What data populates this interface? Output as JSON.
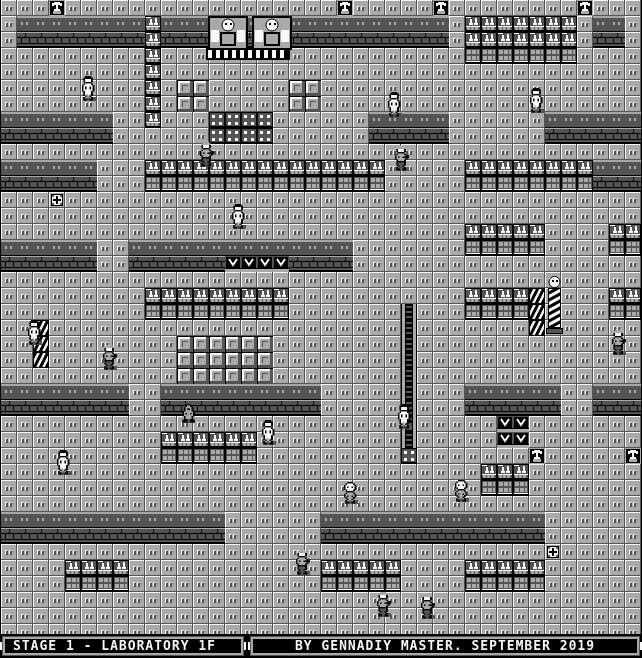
{
  "status_bar": {
    "stage_text": "STAGE 1 - LABORATORY 1F",
    "credits_text": "BY GENNADIY MASTER. SEPTEMBER 2019"
  },
  "palette": {
    "k": "#000000",
    "d": "#545454",
    "l": "#a9a9a9",
    "w": "#f8f8f8"
  },
  "map": {
    "tile_size": 16,
    "cols": 40,
    "rows": 40,
    "legend": {
      ".": "floor-tile",
      "=": "wall-top",
      "#": "wall-face",
      "S": "shelf-flasks",
      "s": "shelf-boxes",
      "C": "crate",
      "V": "press-machine",
      "/": "hazard-pillar",
      "A": "alcove-statue",
      "+": "first-aid-box",
      "o": "lab-table-dots",
      "|": "conveyor"
    },
    "rows_data": [
      "...A.................A.....A........A...",
      ".========S==================.SSSSSSS.==.",
      ".########S##################.SSSSSSS.##.",
      ".........S...................sssssss....",
      ".........S..............................",
      ".........S.CC.....CC....................",
      ".........S.CC.....CC....................",
      "=======..S...oooo......=====......======",
      "#######......oooo......#####......######",
      "........................................",
      "======...SSSSSSSSSSSSSSS.....SSSSSSSS===",
      "######...sssssssssssssss.....ssssssss###",
      "...+....................................",
      "........................................",
      ".............................SSSSS....SS",
      "======..==============.......sssss....ss",
      "######..######VVVV####..................",
      "........................................",
      ".........SSSSSSSSS...........SSSS/....SS",
      ".........sssssssss.......|...ssss/....ss",
      "../......................|......./......",
      "../........CCCCCC........|..............",
      "../........CCCCCC........|..............",
      "...........CCCCCC........|..............",
      "========..==========.....|...======..===",
      "########..##########.....|...######..###",
      ".........................|.....VV.......",
      "..........SSSSSS.........|.....VV.......",
      "..........ssssss.........o.......A.....A",
      "..............................SSS.......",
      "..............................sss.......",
      "........................................",
      "==============......==============......",
      "##############......##############......",
      "..................................+.....",
      "....SSSS............SSSSS....SSSSS......",
      "....ssss............sssss....sssss......",
      "........................................",
      "........................................",
      "........................................"
    ]
  },
  "machine": {
    "name": "twin-robot-machine",
    "x": 206,
    "y": 16
  },
  "mannequin": {
    "name": "striped-mannequin",
    "x": 546,
    "y": 276
  },
  "sprites": {
    "defs": {
      "scientist": [
        "..kkkk....",
        ".kkkkkk...",
        ".kwwwwk...",
        ".kwwwwk...",
        "..kkkk....",
        ".kwwwwk...",
        "kwwwwwwk..",
        "kwkwwkwk..",
        "kwkwwkwk..",
        "kwwwwwwk..",
        ".kwwwwk...",
        ".kwwwwk...",
        ".kwlwlk...",
        "..kllk....",
        ".kl..lk...",
        ".kk..kk..."
      ],
      "soldier": [
        "..llll....",
        ".llllll...",
        ".kwwwwk...",
        ".kwwwwk...",
        "..kkkk....",
        ".kllllk...",
        "kllllllkk.",
        "klkllkkkk.",
        "kllllllk..",
        ".kllllk...",
        ".kkkkkk...",
        ".kddddk...",
        ".kddddk...",
        "..kddk....",
        ".kd..dk...",
        ".kk..kk..."
      ],
      "robot": [
        "..kkkk....",
        ".kwwwwk...",
        "kwwwwwwk..",
        "kwkwwkwk..",
        "kwwwwwwk..",
        ".kwwwwk...",
        "..kkkk....",
        ".kllllk...",
        "kllllllk..",
        "klkllklk..",
        ".kllllk...",
        "..kllk....",
        ".kl..lk...",
        ".kk..kk..."
      ],
      "knight": [
        "....kk....",
        "...kllk...",
        "..kllllk..",
        "..klkklk..",
        "..kllllk..",
        ".kllllllk.",
        ".klkllklk.",
        ".kllllllk.",
        "..kllllk..",
        "..kl..lk..",
        "..kk..kk..",
        ".kkk..kkk."
      ]
    },
    "instances": [
      {
        "type": "scientist",
        "x": 82,
        "y": 76
      },
      {
        "type": "scientist",
        "x": 388,
        "y": 92
      },
      {
        "type": "scientist",
        "x": 530,
        "y": 88
      },
      {
        "type": "soldier",
        "x": 200,
        "y": 142
      },
      {
        "type": "soldier",
        "x": 395,
        "y": 146
      },
      {
        "type": "scientist",
        "x": 232,
        "y": 204
      },
      {
        "type": "scientist",
        "x": 28,
        "y": 320
      },
      {
        "type": "soldier",
        "x": 103,
        "y": 345
      },
      {
        "type": "knight",
        "x": 181,
        "y": 404
      },
      {
        "type": "scientist",
        "x": 262,
        "y": 420
      },
      {
        "type": "scientist",
        "x": 398,
        "y": 404
      },
      {
        "type": "soldier",
        "x": 612,
        "y": 330
      },
      {
        "type": "scientist",
        "x": 57,
        "y": 450
      },
      {
        "type": "robot",
        "x": 344,
        "y": 482
      },
      {
        "type": "robot",
        "x": 455,
        "y": 480
      },
      {
        "type": "soldier",
        "x": 296,
        "y": 550
      },
      {
        "type": "soldier",
        "x": 377,
        "y": 592
      },
      {
        "type": "soldier",
        "x": 421,
        "y": 594
      }
    ]
  }
}
